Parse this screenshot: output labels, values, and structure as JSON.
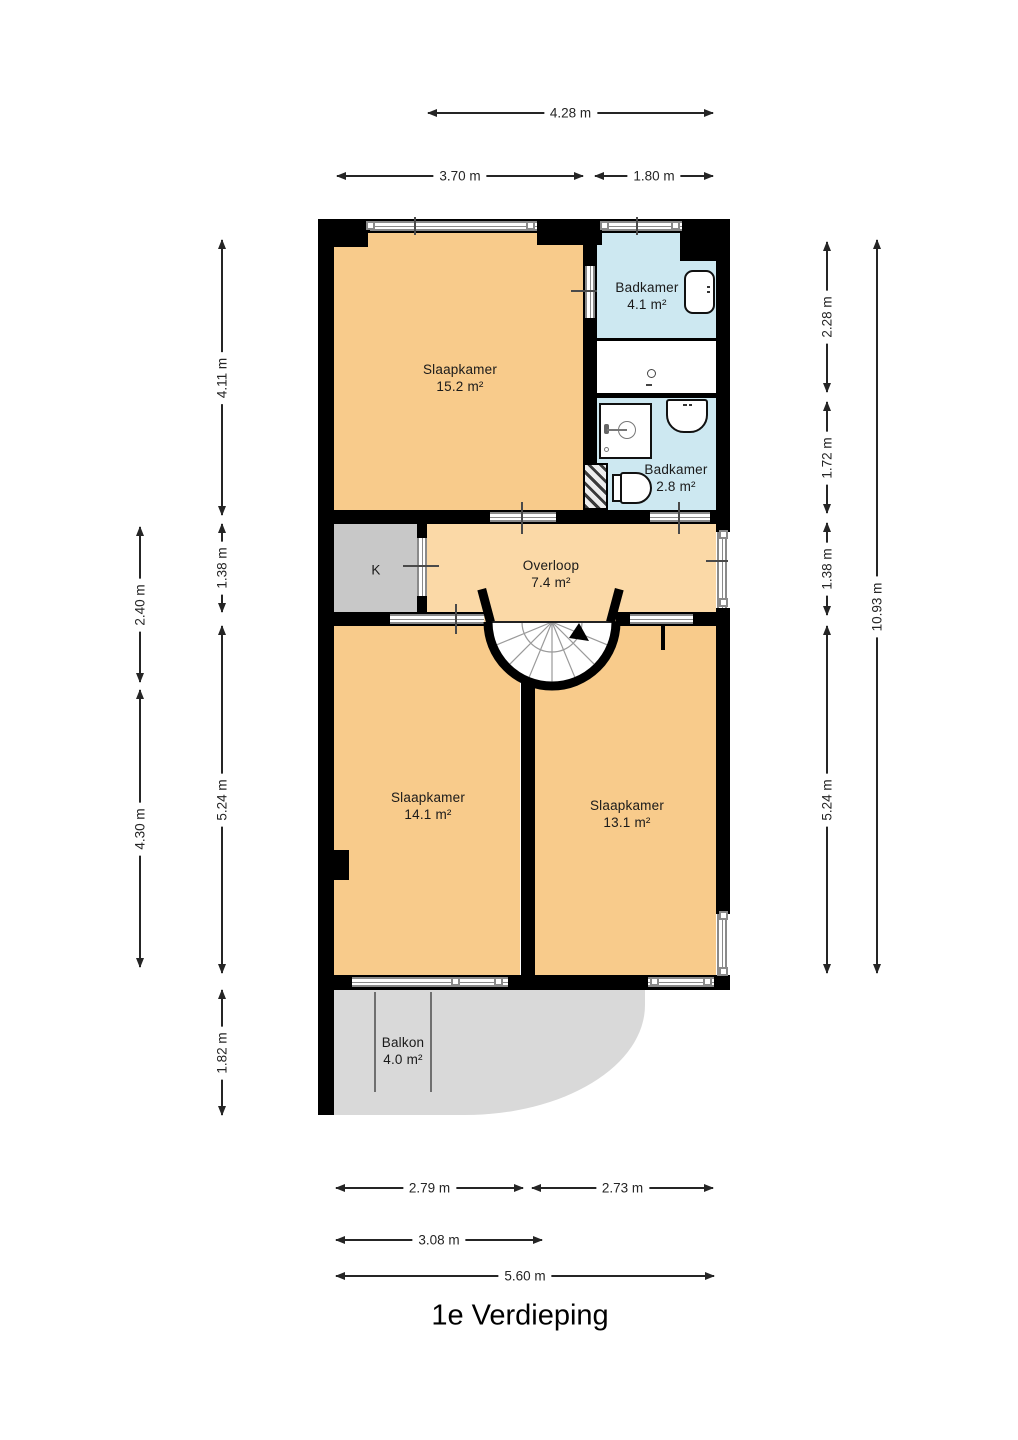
{
  "title": "1e Verdieping",
  "colors": {
    "wall": "#000000",
    "window_frame": "#8a8a8a",
    "bedroom_fill": "#F8CB8B",
    "hall_fill": "#FBD9A7",
    "bath_fill": "#CDE8F1",
    "closet_fill": "#C8C8C8",
    "balcony_fill": "#D9D9D9",
    "dimension_line": "#252525",
    "text": "#1a1a1a"
  },
  "floor_plan": {
    "rooms": [
      {
        "id": "slaapkamer-1",
        "name": "Slaapkamer",
        "area": "15.2 m²",
        "fill": "#F8CB8B"
      },
      {
        "id": "badkamer-1",
        "name": "Badkamer",
        "area": "4.1 m²",
        "fill": "#CDE8F1"
      },
      {
        "id": "badkamer-2",
        "name": "Badkamer",
        "area": "2.8 m²",
        "fill": "#CDE8F1"
      },
      {
        "id": "overloop",
        "name": "Overloop",
        "area": "7.4 m²",
        "fill": "#FBD9A7"
      },
      {
        "id": "closet",
        "name": "K",
        "area": "",
        "fill": "#C8C8C8"
      },
      {
        "id": "slaapkamer-2",
        "name": "Slaapkamer",
        "area": "14.1 m²",
        "fill": "#F8CB8B"
      },
      {
        "id": "slaapkamer-3",
        "name": "Slaapkamer",
        "area": "13.1 m²",
        "fill": "#F8CB8B"
      },
      {
        "id": "balkon",
        "name": "Balkon",
        "area": "4.0 m²",
        "fill": "#D9D9D9"
      }
    ],
    "dimensions": {
      "top": [
        "4.28 m",
        "3.70 m",
        "1.80 m"
      ],
      "bottom": [
        "2.79 m",
        "2.73 m",
        "3.08 m",
        "5.60 m"
      ],
      "left": [
        "4.11 m",
        "1.38 m",
        "2.40 m",
        "4.30 m",
        "5.24 m",
        "1.82 m"
      ],
      "right": [
        "2.28 m",
        "1.72 m",
        "1.38 m",
        "5.24 m",
        "10.93 m"
      ]
    },
    "fixtures": [
      "bathtub",
      "washbasin",
      "shower",
      "toilet",
      "spiral-staircase",
      "shaft"
    ]
  }
}
